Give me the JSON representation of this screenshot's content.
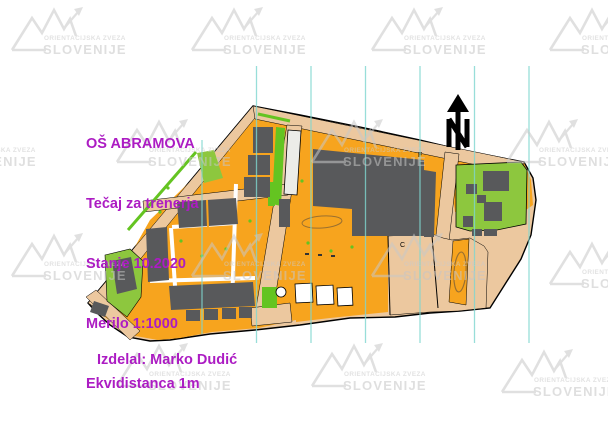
{
  "title_block": {
    "lines": [
      "OŠ ABRAMOVA",
      "Tečaj za trenerja",
      "Stanje 10.2020",
      "Merilo 1:1000",
      "Ekvidistanca 1m"
    ],
    "color": "#AC1CC3"
  },
  "credit": {
    "text": "Izdelal: Marko Dudić"
  },
  "watermark": {
    "line1": "ORIENTACIJSKA ZVEZA",
    "line2": "SLOVENIJE",
    "color": "#C8C8C8"
  },
  "north_arrow": {
    "letter": "N"
  },
  "map_labels": [
    {
      "text": "F"
    },
    {
      "text": "C"
    }
  ],
  "colors": {
    "open_land_orange": "#F7A41E",
    "paved_tan": "#ECC89F",
    "building_gray": "#58595B",
    "vegetation_green": "#8DC73E",
    "strip_green": "#64C421",
    "magnetic_line_cyan": "#7FD6D0",
    "title_magenta": "#AC1CC3",
    "watermark_gray": "#C8C8C8",
    "contour_brown": "#9A7030"
  }
}
